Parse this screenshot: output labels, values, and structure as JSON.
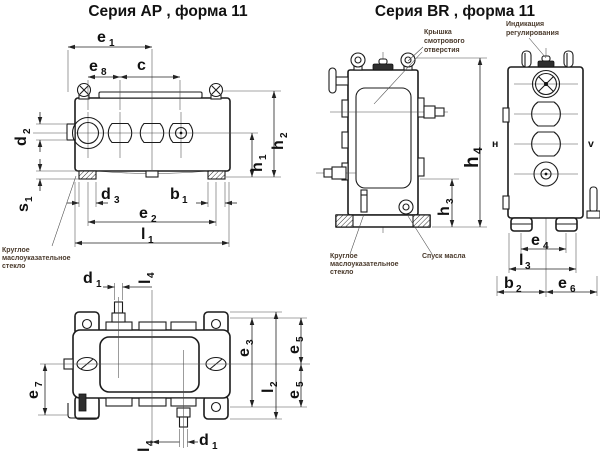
{
  "titles": {
    "ap": "Серия АР , форма 11",
    "br": "Серия BR , форма 11"
  },
  "labels": {
    "e1": {
      "b": "e",
      "s": "1"
    },
    "e8": {
      "b": "e",
      "s": "8"
    },
    "c": {
      "b": "c",
      "s": ""
    },
    "d2": {
      "b": "d",
      "s": "2"
    },
    "s1": {
      "b": "s",
      "s": "1"
    },
    "d3": {
      "b": "d",
      "s": "3"
    },
    "b1": {
      "b": "b",
      "s": "1"
    },
    "e2": {
      "b": "e",
      "s": "2"
    },
    "l1": {
      "b": "l",
      "s": "1"
    },
    "h1": {
      "b": "h",
      "s": "1"
    },
    "h2": {
      "b": "h",
      "s": "2"
    },
    "h3": {
      "b": "h",
      "s": "3"
    },
    "h4": {
      "b": "h",
      "s": "4"
    },
    "d1": {
      "b": "d",
      "s": "1"
    },
    "l4": {
      "b": "l",
      "s": "4"
    },
    "e7": {
      "b": "e",
      "s": "7"
    },
    "e3": {
      "b": "e",
      "s": "3"
    },
    "l2": {
      "b": "l",
      "s": "2"
    },
    "e5": {
      "b": "e",
      "s": "5"
    },
    "e4": {
      "b": "e",
      "s": "4"
    },
    "l3": {
      "b": "l",
      "s": "3"
    },
    "b2": {
      "b": "b",
      "s": "2"
    },
    "e6": {
      "b": "e",
      "s": "6"
    },
    "n": "н",
    "v": "v"
  },
  "annotations": {
    "oil_glass_l1": "Круглое",
    "oil_glass_l2": "маслоуказательное",
    "oil_glass_l3": "стекло",
    "cover_l1": "Крышка",
    "cover_l2": "смотрового",
    "cover_l3": "отверстия",
    "indication_l1": "Индикация",
    "indication_l2": "регулирования",
    "drain": "Спуск масла"
  },
  "colors": {
    "line": "#1c1c1c",
    "annotation": "#4a3a2c",
    "background": "#ffffff"
  }
}
